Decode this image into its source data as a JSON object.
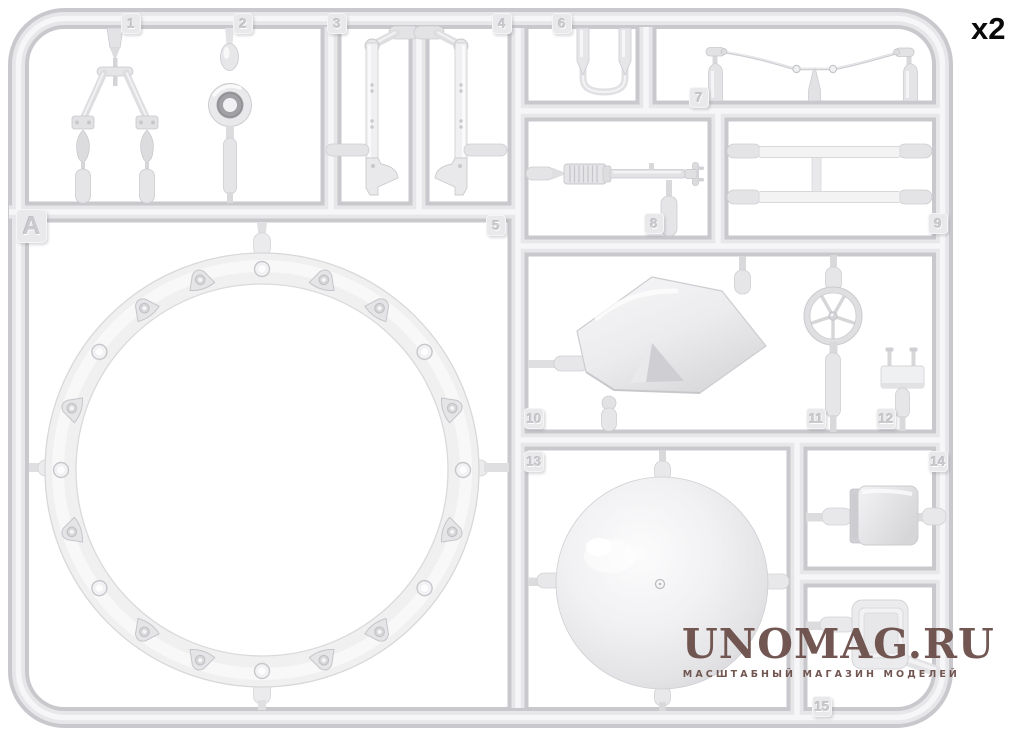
{
  "sheet": {
    "sprue_letter": "A",
    "quantity_label": "x2",
    "part_labels": [
      "1",
      "2",
      "3",
      "4",
      "5",
      "6",
      "7",
      "8",
      "9",
      "10",
      "11",
      "12",
      "13",
      "14",
      "15"
    ]
  },
  "watermark": {
    "title": "UNOMAG.RU",
    "subtitle": "МАСШТАБНЫЙ МАГАЗИН МОДЕЛЕЙ"
  },
  "colors": {
    "background": "#ffffff",
    "plastic_base": "#e8e8ea",
    "plastic_mid": "#d9d9dc",
    "plastic_shadow": "#c9c9cd",
    "plastic_highlight": "#f6f6f8",
    "watermark_text": "#6b4e49",
    "quantity_text": "#0a0a0a"
  }
}
